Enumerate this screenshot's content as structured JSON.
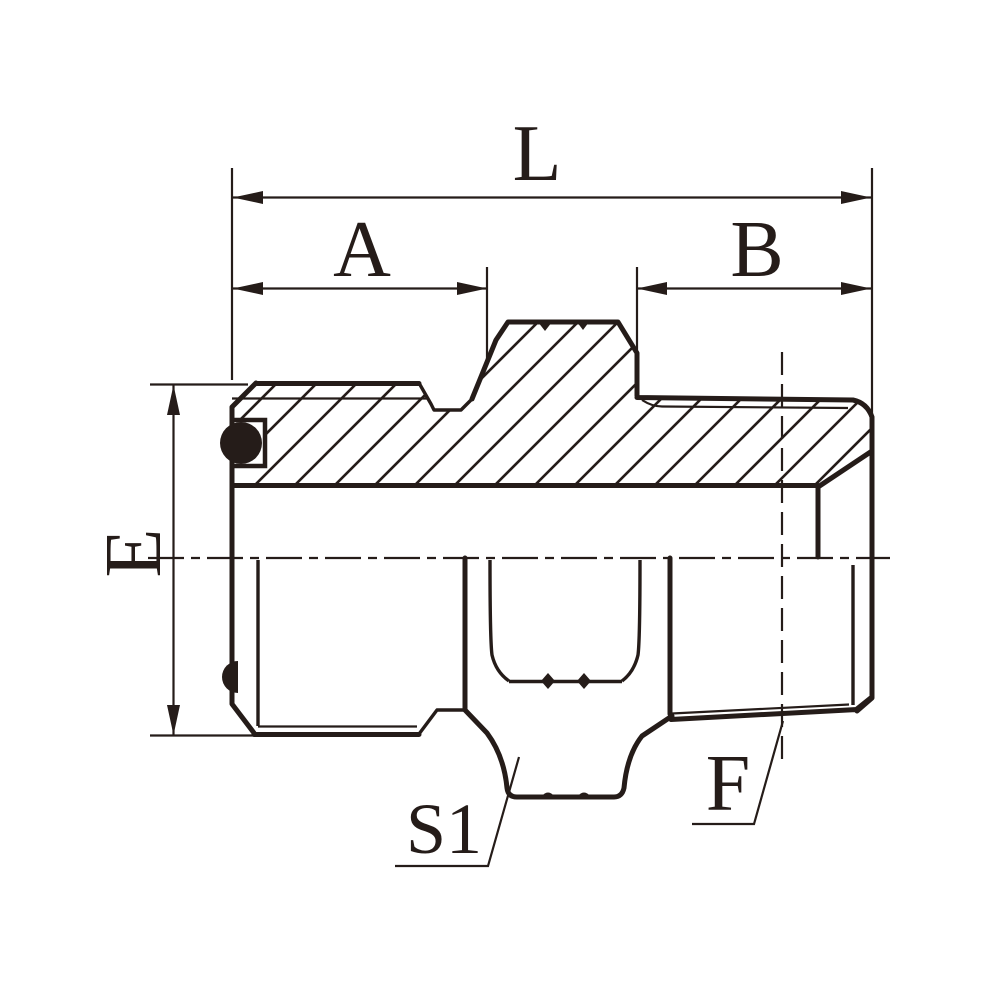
{
  "drawing": {
    "type": "technical-drawing",
    "subject": "hydraulic male stud pipe adapter, half-section view",
    "colors": {
      "ink": "#251c19",
      "background": "#ffffff"
    },
    "dimensions": {
      "overall_length_label": "L",
      "left_thread_length_label": "A",
      "right_thread_length_label": "B",
      "left_thread_diameter_label": "E",
      "hex_across_flats_label": "S1",
      "right_thread_size_label": "F"
    }
  }
}
